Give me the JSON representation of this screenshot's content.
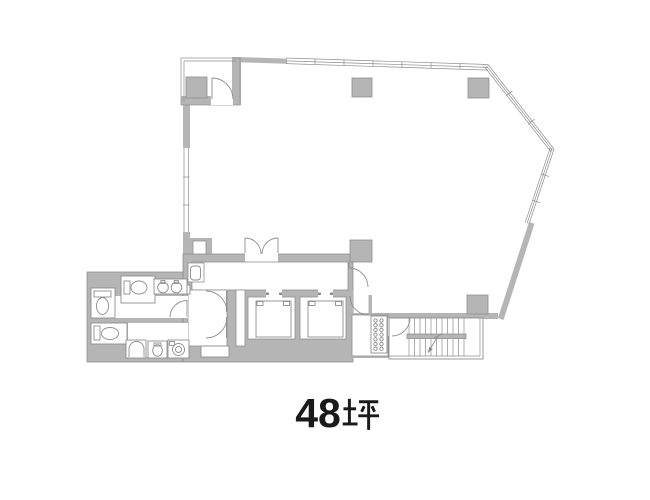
{
  "floorplan": {
    "area_label": {
      "number": "48",
      "unit": "坪",
      "full": "48坪"
    },
    "colors": {
      "background": "#ffffff",
      "wall_fill": "#b5b5b5",
      "wall_line": "#8e8e8e",
      "text": "#1a1a1a"
    }
  }
}
